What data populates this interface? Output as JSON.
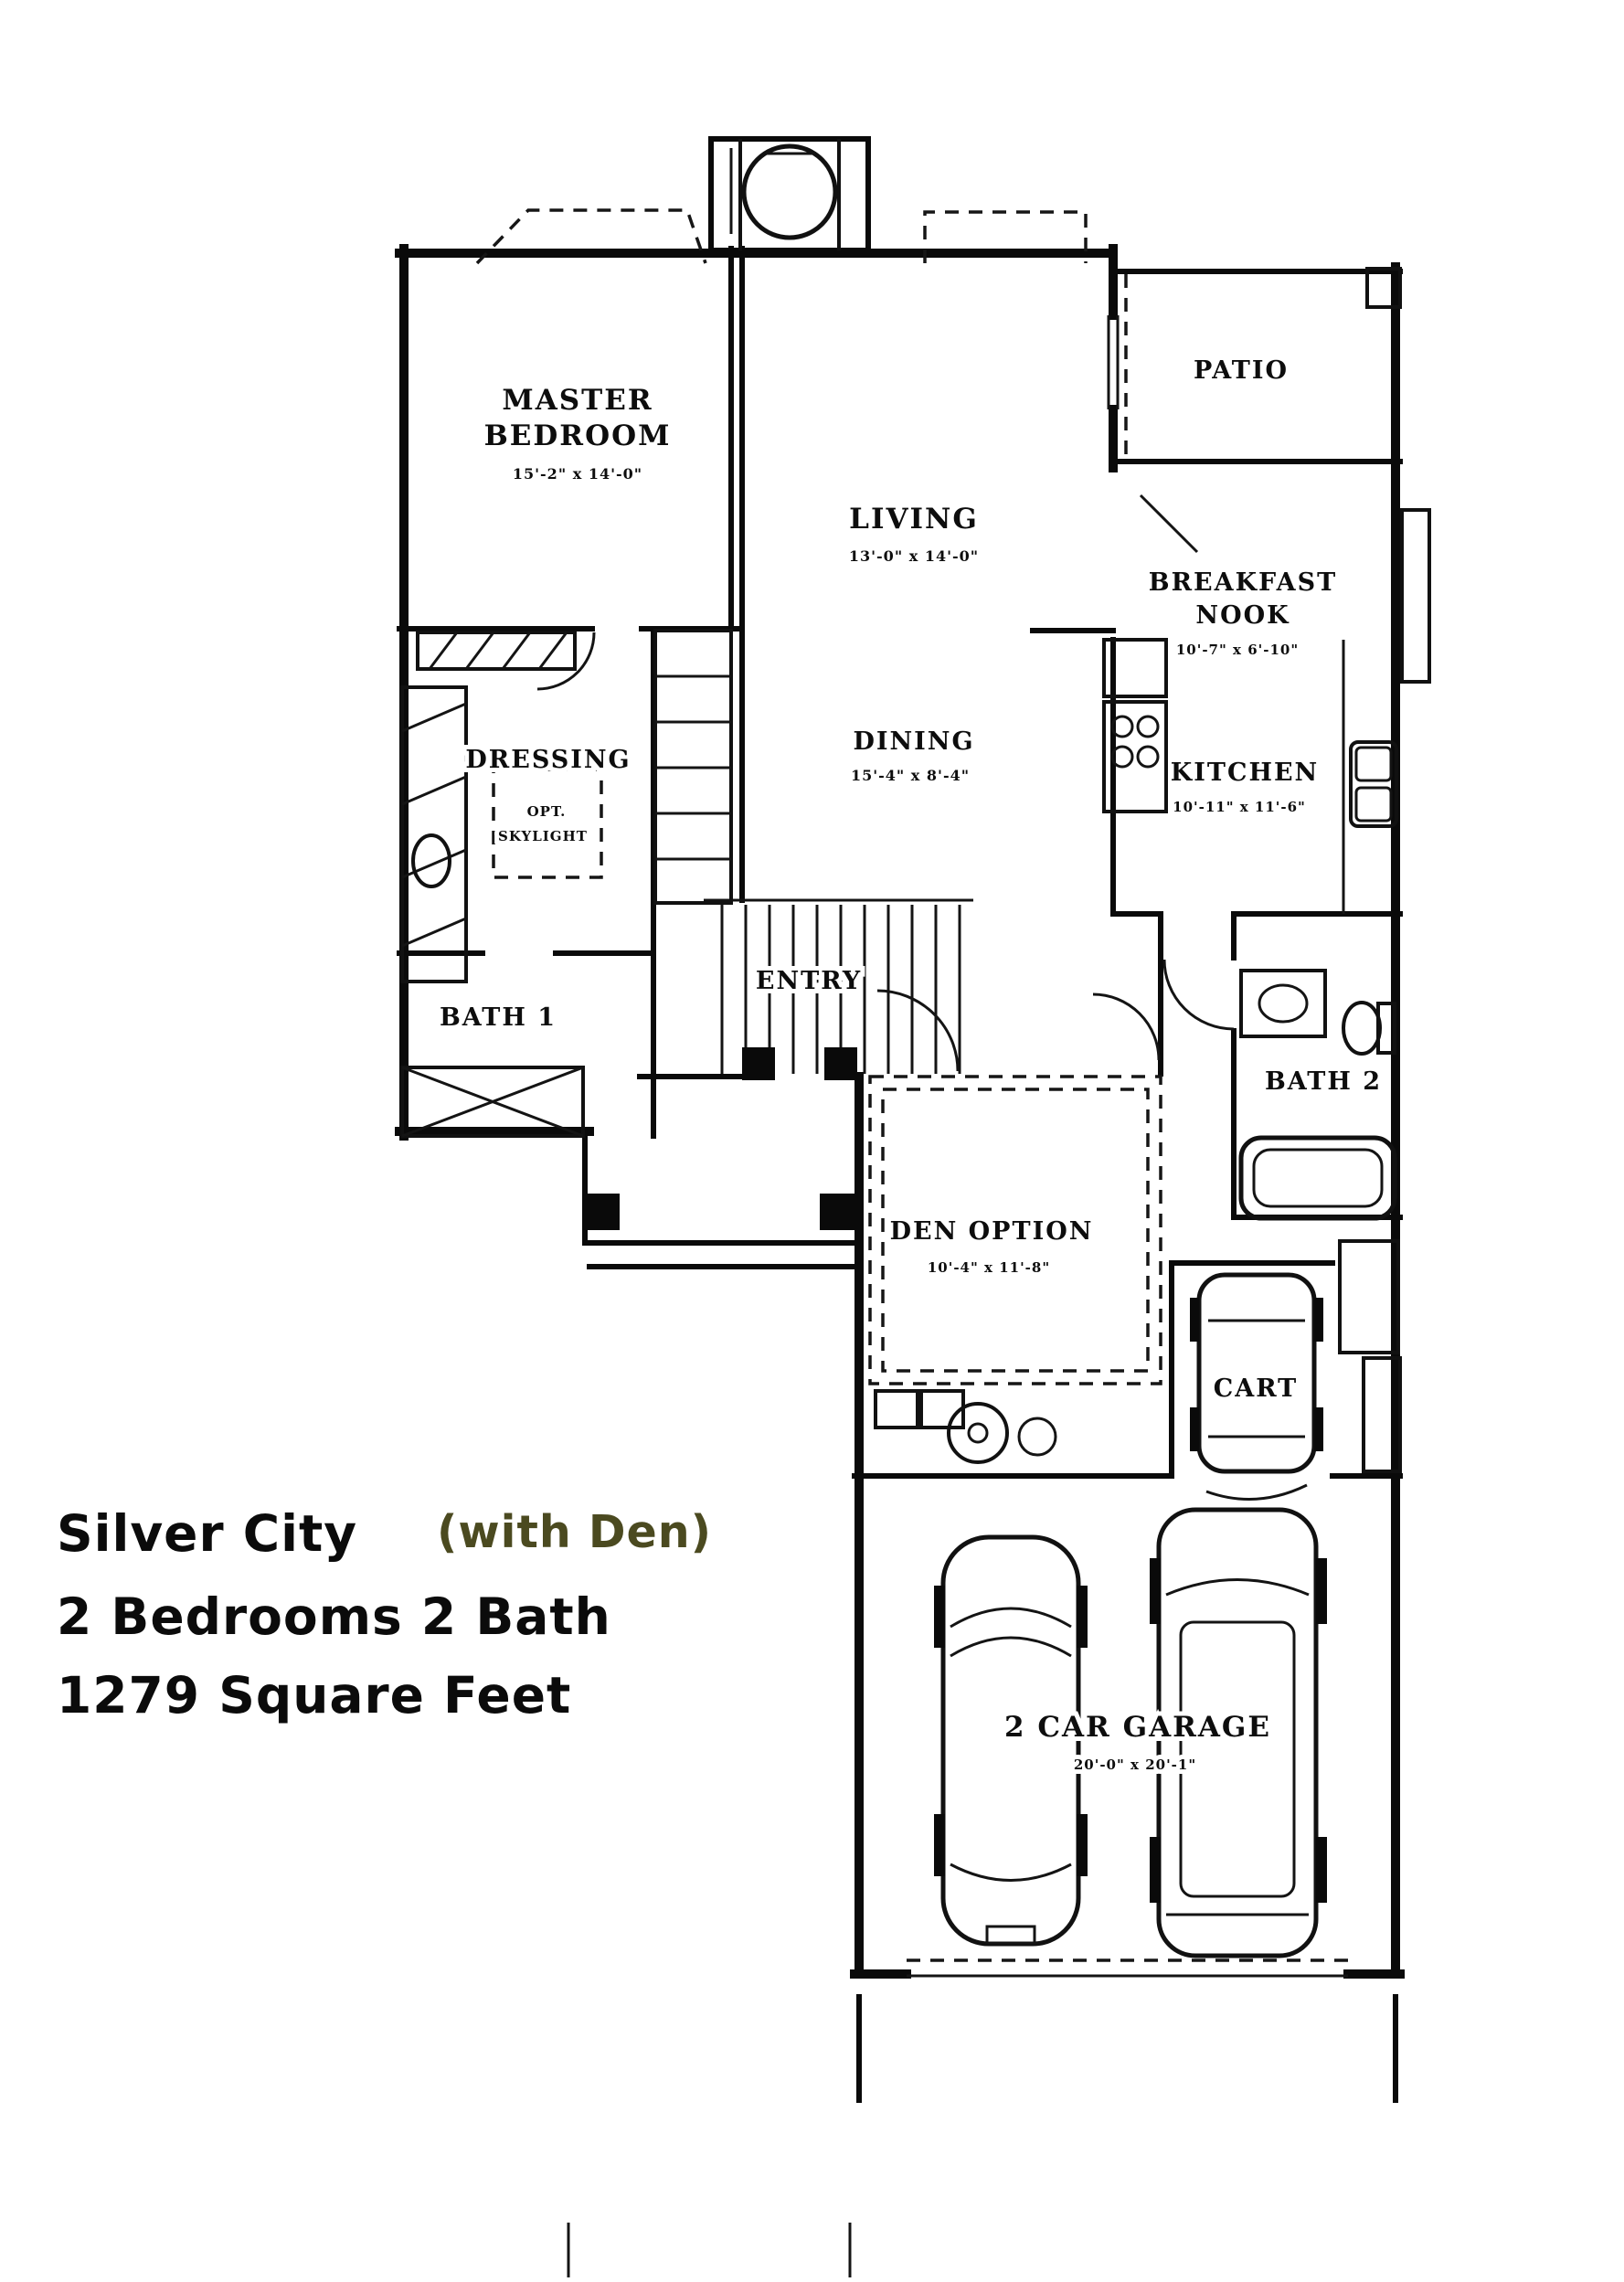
{
  "title": {
    "plan_name": "Silver City",
    "variant": "(with Den)",
    "bedrooms_baths": "2 Bedrooms 2 Bath",
    "area": "1279 Square Feet"
  },
  "colors": {
    "ink": "#0a0a0a",
    "variant_text": "#4b4a20",
    "paper": "#ffffff"
  },
  "rooms": {
    "master_bedroom": {
      "name_line1": "MASTER",
      "name_line2": "BEDROOM",
      "dims": "15'-2\" x 14'-0\""
    },
    "living": {
      "name": "LIVING",
      "dims": "13'-0\" x 14'-0\""
    },
    "patio": {
      "name": "PATIO"
    },
    "breakfast_nook": {
      "name_line1": "BREAKFAST",
      "name_line2": "NOOK",
      "dims": "10'-7\" x 6'-10\""
    },
    "dressing": {
      "name": "DRESSING",
      "note_line1": "OPT.",
      "note_line2": "SKYLIGHT"
    },
    "dining": {
      "name": "DINING",
      "dims": "15'-4\" x 8'-4\""
    },
    "kitchen": {
      "name": "KITCHEN",
      "dims": "10'-11\" x 11'-6\""
    },
    "bath_1": {
      "name": "BATH 1"
    },
    "entry": {
      "name": "ENTRY"
    },
    "bath_2": {
      "name": "BATH 2"
    },
    "den": {
      "name": "DEN OPTION",
      "dims": "10'-4\" x 11'-8\""
    },
    "cart": {
      "name": "CART"
    },
    "garage": {
      "name": "2 CAR GARAGE",
      "dims": "20'-0\" x 20'-1\""
    }
  }
}
